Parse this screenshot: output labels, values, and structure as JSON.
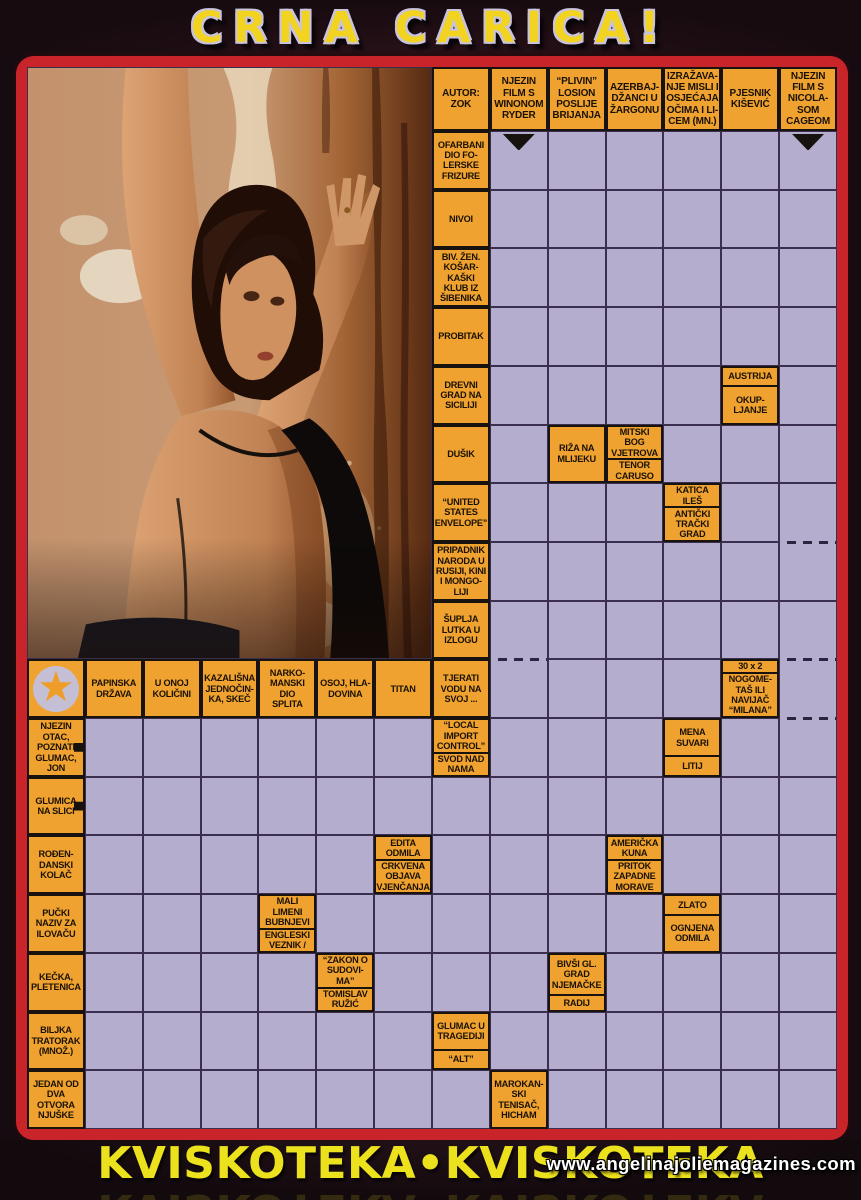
{
  "header": {
    "title": "CRNA CARICA!"
  },
  "footer": {
    "title": "KVISKOTEKA•KVISKOTEKA",
    "watermark": "www.angelinajoliemagazines.com"
  },
  "icons": {
    "star": "★"
  },
  "colors": {
    "clue_bg": "#efa22f",
    "answer_bg": "#b5adce",
    "grid_line": "#3a2f4e",
    "frame_red": "#c8242a",
    "title_yellow": "#f2d31f",
    "footer_yellow": "#ece11d"
  },
  "grid": {
    "cols": 14,
    "rows": 18,
    "photo": {
      "col_start": 1,
      "col_end": 7,
      "row_start": 0,
      "row_end": 9,
      "description": "woman leaning against peeling rust-stained wall"
    },
    "arrows_down": [
      {
        "c": 9,
        "r": 1
      },
      {
        "c": 14,
        "r": 1
      }
    ],
    "dashed_marks": [
      {
        "c": 9,
        "r": 10
      },
      {
        "c": 14,
        "r": 8
      },
      {
        "c": 14,
        "r": 10
      },
      {
        "c": 14,
        "r": 11
      }
    ],
    "cells": [
      {
        "c": 8,
        "r": 0,
        "text": "AUTOR:\nZOK"
      },
      {
        "c": 9,
        "r": 0,
        "text": "NJEZIN\nFILM S\nWINONOM\nRYDER"
      },
      {
        "c": 10,
        "r": 0,
        "text": "“PLIVIN”\nLOSION\nPOSLIJE\nBRIJANJA"
      },
      {
        "c": 11,
        "r": 0,
        "text": "AZERBAJ-\nDŽANCI U\nŽARGONU"
      },
      {
        "c": 12,
        "r": 0,
        "text": "IZRAŽAVA-\nNJE MISLI I\nOSJEĆAJA\nOČIMA I LI-\nCEM (MN.)"
      },
      {
        "c": 13,
        "r": 0,
        "text": "PJESNIK\nKIŠEVIĆ"
      },
      {
        "c": 14,
        "r": 0,
        "text": "NJEZIN\nFILM S\nNICOLA-\nSOM\nCAGEOM"
      },
      {
        "c": 8,
        "r": 1,
        "text": "OFARBANI\nDIO FO-\nLERSKE\nFRIZURE"
      },
      {
        "c": 8,
        "r": 2,
        "text": "NIVOI"
      },
      {
        "c": 8,
        "r": 3,
        "text": "BIV. ŽEN.\nKOŠAR-\nKAŠKI\nKLUB IZ\nŠIBENIKA"
      },
      {
        "c": 8,
        "r": 4,
        "text": "PROBITAK"
      },
      {
        "c": 8,
        "r": 5,
        "text": "DREVNI\nGRAD NA\nSICILIJI"
      },
      {
        "c": 13,
        "r": 5,
        "top": "AUSTRIJA",
        "bottom": "OKUP-\nLJANJE"
      },
      {
        "c": 8,
        "r": 6,
        "text": "DUŠIK"
      },
      {
        "c": 10,
        "r": 6,
        "text": "RIŽA NA\nMLIJEKU"
      },
      {
        "c": 11,
        "r": 6,
        "top": "MITSKI\nBOG\nVJETROVA",
        "bottom": "TENOR\nCARUSO"
      },
      {
        "c": 8,
        "r": 7,
        "text": "“UNITED\nSTATES\nENVELOPE”"
      },
      {
        "c": 12,
        "r": 7,
        "top": "KATICA\nILEŠ",
        "bottom": "ANTIČKI\nTRAČKI\nGRAD"
      },
      {
        "c": 8,
        "r": 8,
        "text": "PRIPADNIK\nNARODA U\nRUSIJI, KINI\nI MONGO-\nLIJI"
      },
      {
        "c": 8,
        "r": 9,
        "text": "ŠUPLJA\nLUTKA U\nIZLOGU"
      },
      {
        "c": 1,
        "r": 10,
        "star": true
      },
      {
        "c": 2,
        "r": 10,
        "text": "PAPINSKA\nDRŽAVA"
      },
      {
        "c": 3,
        "r": 10,
        "text": "U ONOJ\nKOLIČINI"
      },
      {
        "c": 4,
        "r": 10,
        "text": "KAZALIŠNA\nJEDNOČIN-\nKA, SKEČ"
      },
      {
        "c": 5,
        "r": 10,
        "text": "NARKO-\nMANSKI\nDIO\nSPLITA"
      },
      {
        "c": 6,
        "r": 10,
        "text": "OSOJ, HLA-\nDOVINA"
      },
      {
        "c": 7,
        "r": 10,
        "text": "TITAN"
      },
      {
        "c": 8,
        "r": 10,
        "text": "TJERATI\nVODU NA\nSVOJ ..."
      },
      {
        "c": 13,
        "r": 10,
        "top": "30 x 2",
        "bottom": "NOGOME-\nTAŠ ILI\nNAVIJAČ\n“MILANA”"
      },
      {
        "c": 1,
        "r": 11,
        "text": "NJEZIN\nOTAC,\nPOZNATI\nGLUMAC,\nJON",
        "arrow": "right"
      },
      {
        "c": 8,
        "r": 11,
        "top": "“LOCAL\nIMPORT\nCONTROL”",
        "bottom": "SVOD NAD\nNAMA"
      },
      {
        "c": 12,
        "r": 11,
        "top": "MENA\nSUVARI",
        "bottom": "LITIJ"
      },
      {
        "c": 1,
        "r": 12,
        "text": "GLUMICA\nNA SLICI",
        "arrow": "right"
      },
      {
        "c": 1,
        "r": 13,
        "text": "ROĐEN-\nDANSKI\nKOLAČ"
      },
      {
        "c": 7,
        "r": 13,
        "top": "EDITA\nODMILA",
        "bottom": "CRKVENA\nOBJAVA\nVJENČANJA"
      },
      {
        "c": 11,
        "r": 13,
        "top": "AMERIČKA\nKUNA",
        "bottom": "PRITOK\nZAPADNE\nMORAVE"
      },
      {
        "c": 1,
        "r": 14,
        "text": "PUČKI\nNAZIV ZA\nILOVAČU"
      },
      {
        "c": 5,
        "r": 14,
        "top": "MALI\nLIMENI\nBUBNJEVI",
        "bottom": "ENGLESKI\nVEZNIK /"
      },
      {
        "c": 12,
        "r": 14,
        "top": "ZLATO",
        "bottom": "OGNJENA\nODMILA"
      },
      {
        "c": 1,
        "r": 15,
        "text": "KEČKA,\nPLETENICA"
      },
      {
        "c": 6,
        "r": 15,
        "top": "“ZAKON O\nSUDOVI-\nMA”",
        "bottom": "TOMISLAV\nRUŽIĆ"
      },
      {
        "c": 10,
        "r": 15,
        "top": "BIVŠI GL.\nGRAD\nNJEMAČKE",
        "bottom": "RADIJ"
      },
      {
        "c": 1,
        "r": 16,
        "text": "BILJKA\nTRATORAK\n(MNOŽ.)"
      },
      {
        "c": 8,
        "r": 16,
        "top": "GLUMAC U\nTRAGEDIJI",
        "bottom": "“ALT”"
      },
      {
        "c": 1,
        "r": 17,
        "text": "JEDAN OD\nDVA\nOTVORA\nNJUŠKE"
      },
      {
        "c": 9,
        "r": 17,
        "text": "MAROKAN-\nSKI\nTENISAČ,\nHICHAM"
      }
    ]
  }
}
